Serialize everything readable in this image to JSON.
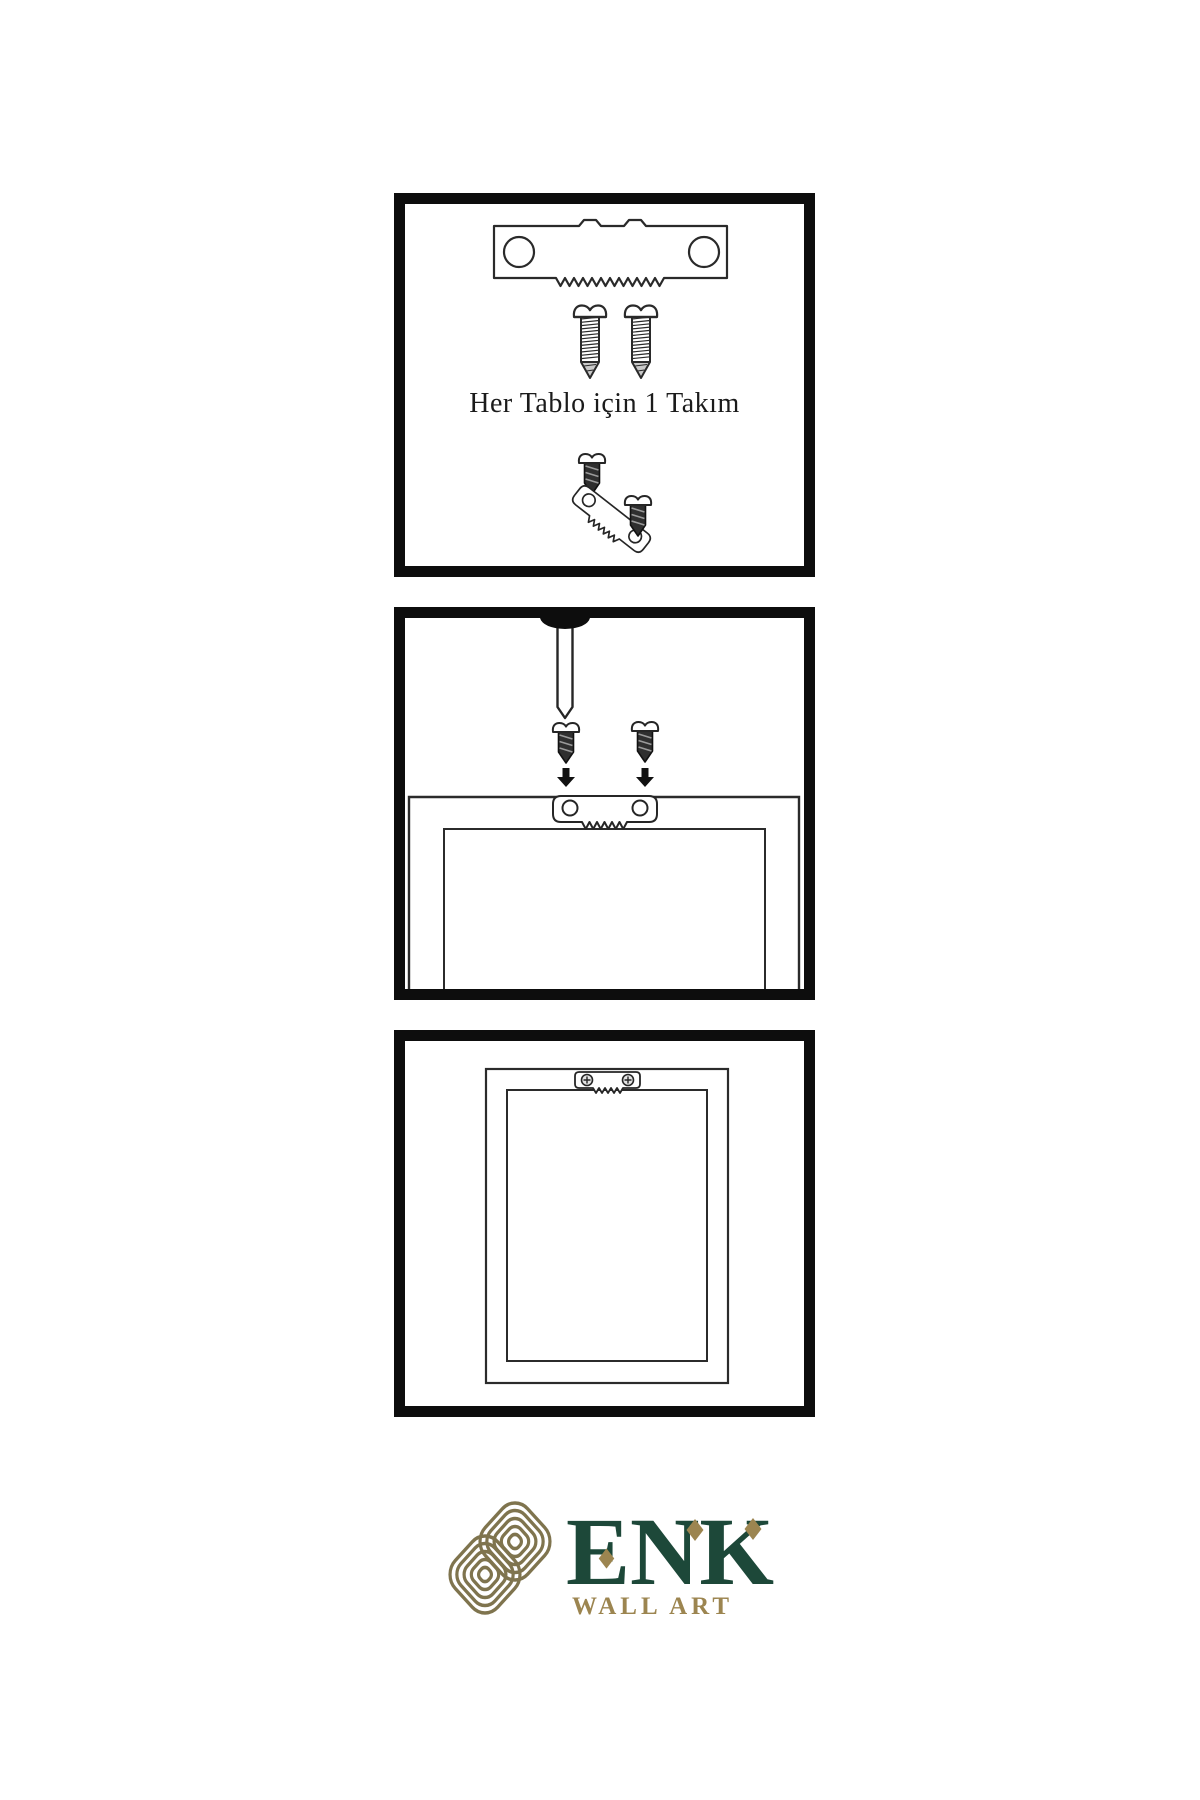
{
  "page": {
    "background": "#ffffff",
    "ink": "#262626",
    "panel_border": "#0d0d0d"
  },
  "panels": [
    {
      "name": "hardware-kit",
      "caption": "Her Tablo için 1 Takım",
      "items": [
        "sawtooth-hanger-plate",
        "screw",
        "screw",
        "screw",
        "tilted-sawtooth-hanger",
        "screw"
      ]
    },
    {
      "name": "hanging-step",
      "caption": "",
      "items": [
        "wall-nail",
        "screw-with-down-arrow",
        "screw-with-down-arrow",
        "frame-back-close-up",
        "mounted-sawtooth-hanger"
      ]
    },
    {
      "name": "finished-frame-back",
      "caption": "",
      "items": [
        "frame-back",
        "mounted-sawtooth-hanger-with-screws"
      ]
    }
  ],
  "icons": {
    "sawtooth-hanger": "serrated metal hanging plate with two screw holes",
    "screw": "pointed wood screw with pan head",
    "nail": "wall nail driven through top edge",
    "arrow-down": "black downward arrow",
    "knot-logo": "interlocking gold knot emblem"
  },
  "brand": {
    "name": "ENK",
    "subtitle": "WALL ART",
    "green": "#1d4839",
    "gold": "#9c8550",
    "knot_bg": "#f6f0e1",
    "knot_stroke": "#7f744e"
  }
}
